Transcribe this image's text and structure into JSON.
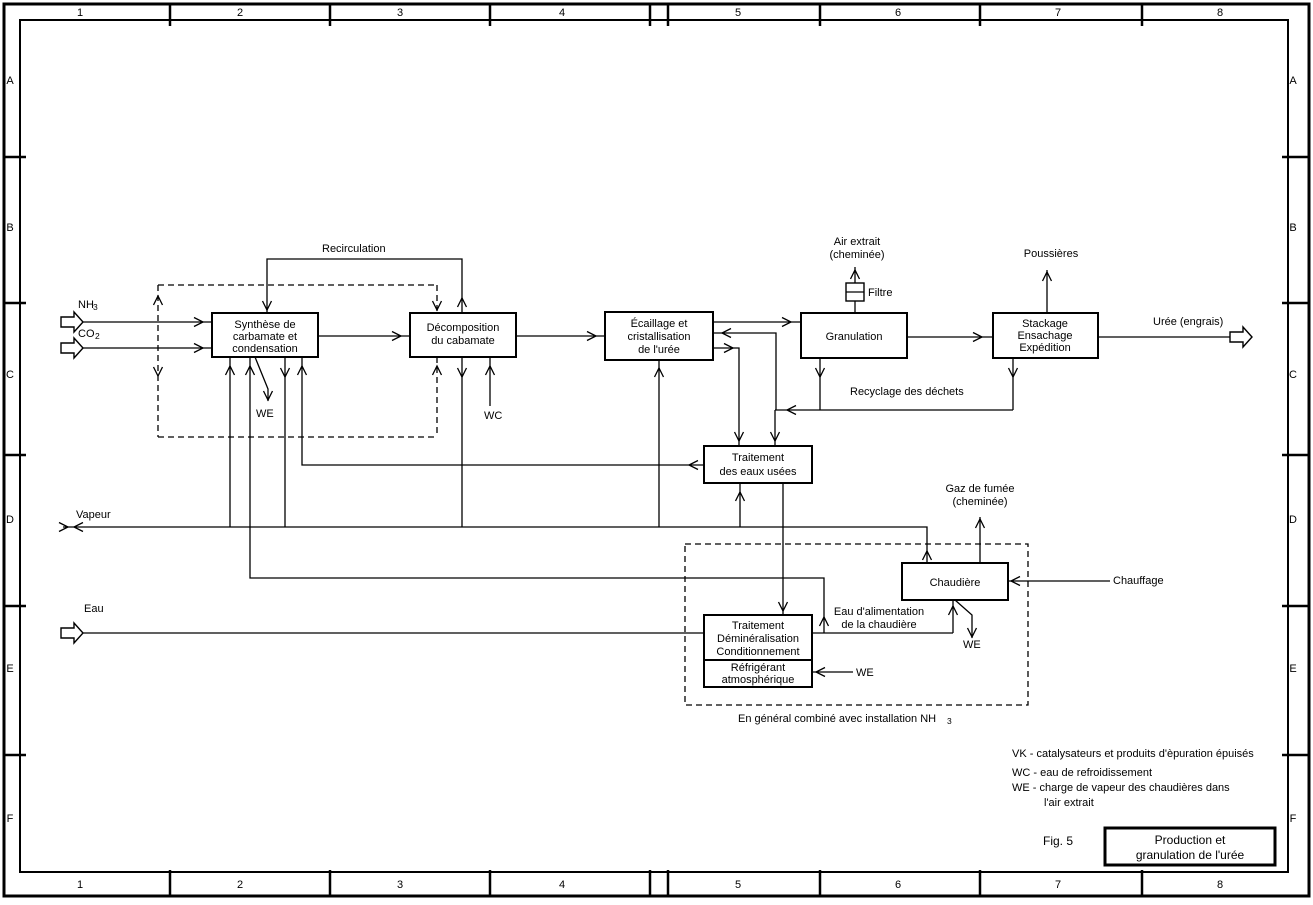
{
  "frame": {
    "columns": [
      "1",
      "2",
      "3",
      "4",
      "5",
      "6",
      "7",
      "8"
    ],
    "rows": [
      "A",
      "B",
      "C",
      "D",
      "E",
      "F"
    ]
  },
  "streams": {
    "nh3": {
      "text": "NH",
      "sub": "3"
    },
    "co2": {
      "text": "CO",
      "sub": "2"
    },
    "vapeur": "Vapeur",
    "eau": "Eau",
    "uree": "Urée (engrais)"
  },
  "process": {
    "synthese": {
      "lines": [
        "Synthèse de",
        "carbamate et",
        "condensation"
      ]
    },
    "decomposition": {
      "lines": [
        "Décomposition",
        "du cabamate"
      ]
    },
    "ecaillage": {
      "lines": [
        "Écaillage et",
        "cristallisation",
        "de l'urée"
      ]
    },
    "granulation": {
      "lines": [
        "Granulation"
      ]
    },
    "stackage": {
      "lines": [
        "Stackage",
        "Ensachage",
        "Expédition"
      ]
    },
    "traitement_eaux": {
      "lines": [
        "Traitement",
        "des eaux usées"
      ]
    },
    "chaudiere": {
      "lines": [
        "Chaudière"
      ]
    },
    "demineralisation": {
      "lines": [
        "Traitement",
        "Déminéralisation",
        "Conditionnement"
      ]
    },
    "refrigerant": {
      "lines": [
        "Réfrigérant",
        "atmosphérique"
      ]
    }
  },
  "flow_labels": {
    "recirculation": "Recirculation",
    "we_synthese": "WE",
    "wc": "WC",
    "air_extrait": [
      "Air extrait",
      "(cheminée)"
    ],
    "filtre": "Filtre",
    "poussieres": "Poussières",
    "recyclage": "Recyclage des déchets",
    "gaz_fumee": [
      "Gaz de fumée",
      "(cheminée)"
    ],
    "chauffage": "Chauffage",
    "eau_alimentation": [
      "Eau d'alimentation",
      "de la chaudière"
    ],
    "we_chaudiere": "WE",
    "we_refrigerant": "WE",
    "note_nh3": {
      "text": "En général combiné avec installation NH",
      "sub": "3"
    }
  },
  "legend": {
    "lines": [
      "VK  -  catalysateurs et produits d'èpuration épuisés",
      "WC -  eau de refroidissement",
      "WE -  charge de vapeur des chaudières dans",
      "l'air extrait"
    ]
  },
  "title_block": {
    "figure": "Fig. 5",
    "title_lines": [
      "Production et",
      "granulation de l'urée"
    ]
  },
  "colors": {
    "ink": "#000000",
    "paper": "#ffffff"
  }
}
